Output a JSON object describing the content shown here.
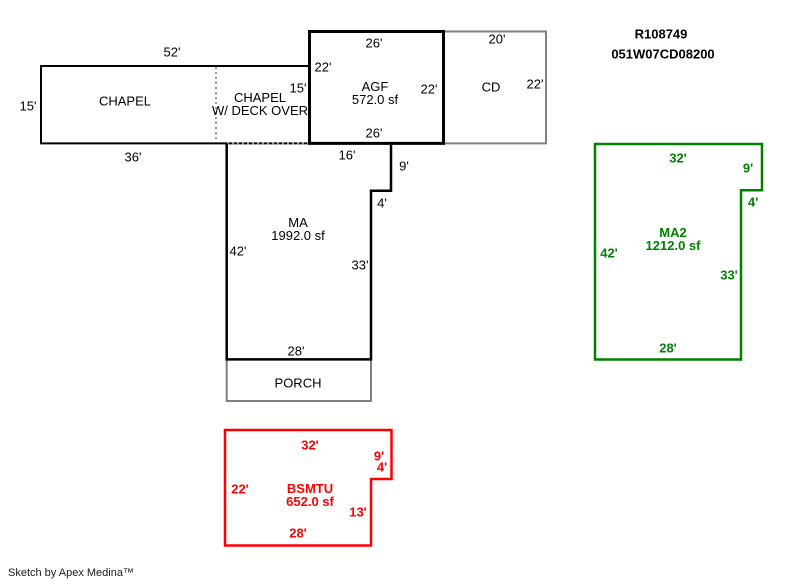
{
  "header": {
    "parcel_id": "R108749",
    "account_number": "051W07CD08200"
  },
  "footer": {
    "credit": "Sketch by Apex Medina™"
  },
  "colors": {
    "outline_black": "#000000",
    "outline_gray": "#808080",
    "dotted_gray": "#999999",
    "outline_green": "#008000",
    "outline_red": "#ff0000"
  },
  "sections": {
    "chapel": {
      "name": "CHAPEL",
      "dim_top": "52'",
      "dim_left": "15'",
      "dim_bottom": "36'"
    },
    "chapel_deck": {
      "name_line1": "CHAPEL",
      "name_line2": "W/ DECK OVER",
      "dim_right": "15'"
    },
    "agf": {
      "name": "AGF",
      "area": "572.0 sf",
      "dim_top": "26'",
      "dim_left": "22'",
      "dim_right": "22'",
      "dim_bottom": "26'"
    },
    "cd": {
      "name": "CD",
      "dim_top": "20'",
      "dim_right": "22'"
    },
    "ma": {
      "name": "MA",
      "area": "1992.0 sf",
      "dim_top": "16'",
      "dim_right_upper": "9'",
      "dim_step": "4'",
      "dim_left": "42'",
      "dim_right_lower": "33'",
      "dim_bottom": "28'"
    },
    "porch": {
      "name": "PORCH"
    },
    "ma2": {
      "name": "MA2",
      "area": "1212.0 sf",
      "dim_top": "32'",
      "dim_right_upper": "9'",
      "dim_step": "4'",
      "dim_left": "42'",
      "dim_right_lower": "33'",
      "dim_bottom": "28'"
    },
    "bsmtu": {
      "name": "BSMTU",
      "area": "652.0 sf",
      "dim_top": "32'",
      "dim_right_upper": "9'",
      "dim_step": "4'",
      "dim_left": "22'",
      "dim_right_lower": "13'",
      "dim_bottom": "28'"
    }
  }
}
